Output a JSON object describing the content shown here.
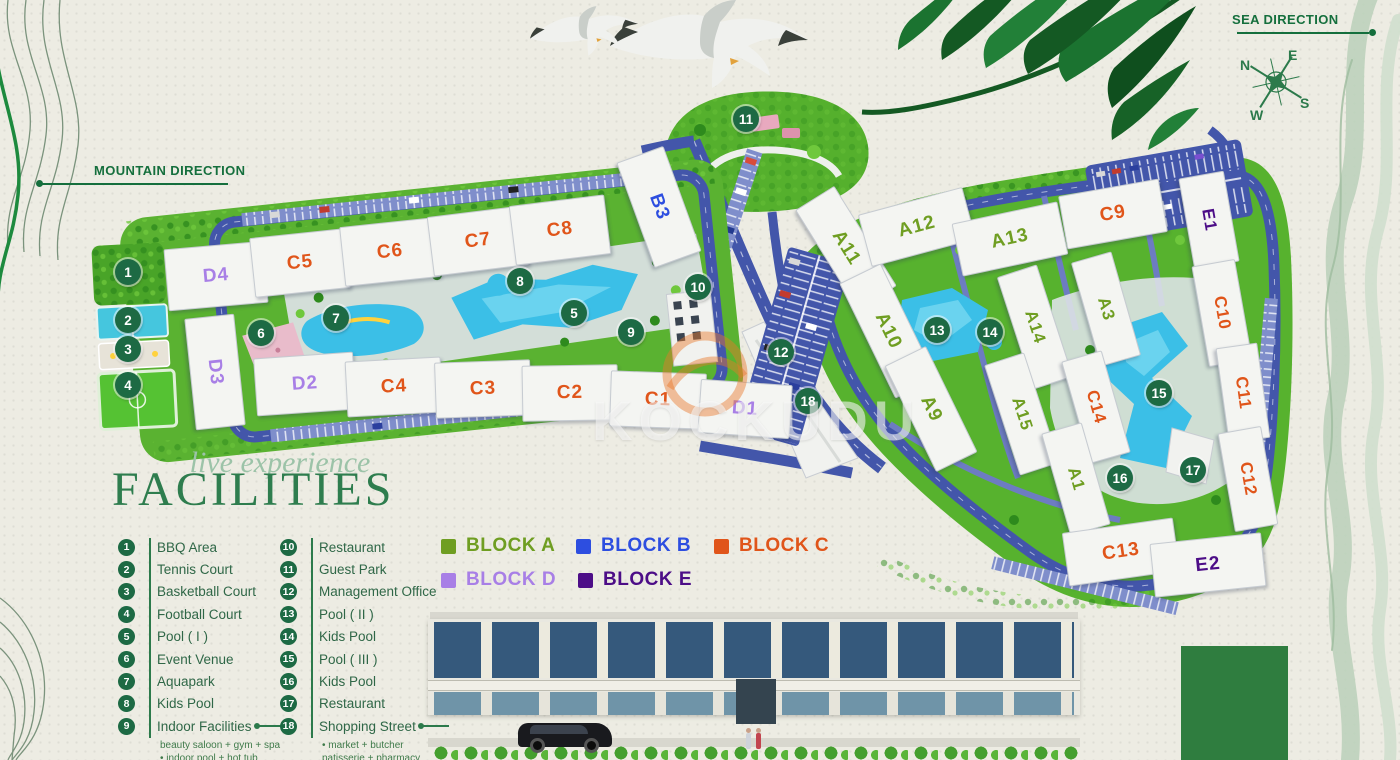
{
  "directions": {
    "sea": "SEA DIRECTION",
    "mountain": "MOUNTAIN DIRECTION"
  },
  "compass": {
    "n": "N",
    "e": "E",
    "s": "S",
    "w": "W"
  },
  "title": {
    "script": "live experience",
    "main": "FACILITIES"
  },
  "facilities": [
    {
      "num": "1",
      "label": "BBQ Area"
    },
    {
      "num": "2",
      "label": "Tennis Court"
    },
    {
      "num": "3",
      "label": "Basketball Court"
    },
    {
      "num": "4",
      "label": "Football Court"
    },
    {
      "num": "5",
      "label": "Pool ( I )"
    },
    {
      "num": "6",
      "label": "Event Venue"
    },
    {
      "num": "7",
      "label": "Aquapark"
    },
    {
      "num": "8",
      "label": "Kids Pool"
    },
    {
      "num": "9",
      "label": "Indoor Facilities",
      "notes": [
        "beauty saloon + gym + spa",
        "indoor pool + hot tub"
      ]
    },
    {
      "num": "10",
      "label": "Restaurant"
    },
    {
      "num": "11",
      "label": "Guest Park"
    },
    {
      "num": "12",
      "label": "Management Office"
    },
    {
      "num": "13",
      "label": "Pool ( II )"
    },
    {
      "num": "14",
      "label": "Kids Pool"
    },
    {
      "num": "15",
      "label": "Pool ( III )"
    },
    {
      "num": "16",
      "label": "Kids Pool"
    },
    {
      "num": "17",
      "label": "Restaurant"
    },
    {
      "num": "18",
      "label": "Shopping Street",
      "notes": [
        "market + butcher",
        "patisserie + pharmacy"
      ]
    }
  ],
  "blocks": [
    {
      "key": "a",
      "label": "BLOCK A",
      "color": "#6f9e22"
    },
    {
      "key": "b",
      "label": "BLOCK B",
      "color": "#2d4ee0"
    },
    {
      "key": "c",
      "label": "BLOCK C",
      "color": "#e0551a"
    },
    {
      "key": "d",
      "label": "BLOCK D",
      "color": "#a87fe6"
    },
    {
      "key": "e",
      "label": "BLOCK E",
      "color": "#4c0d87"
    }
  ],
  "map": {
    "buildings": [
      {
        "label": "D4",
        "block": "D"
      },
      {
        "label": "C5",
        "block": "C"
      },
      {
        "label": "C6",
        "block": "C"
      },
      {
        "label": "C7",
        "block": "C"
      },
      {
        "label": "C8",
        "block": "C"
      },
      {
        "label": "B3",
        "block": "B"
      },
      {
        "label": "D3",
        "block": "D"
      },
      {
        "label": "D2",
        "block": "D"
      },
      {
        "label": "C4",
        "block": "C"
      },
      {
        "label": "C3",
        "block": "C"
      },
      {
        "label": "C2",
        "block": "C"
      },
      {
        "label": "C1",
        "block": "C"
      },
      {
        "label": "D1",
        "block": "D"
      },
      {
        "label": "A11",
        "block": "A"
      },
      {
        "label": "A12",
        "block": "A"
      },
      {
        "label": "A13",
        "block": "A"
      },
      {
        "label": "C9",
        "block": "C"
      },
      {
        "label": "E1",
        "block": "E"
      },
      {
        "label": "A10",
        "block": "A"
      },
      {
        "label": "A9",
        "block": "A"
      },
      {
        "label": "A14",
        "block": "A"
      },
      {
        "label": "A15",
        "block": "A"
      },
      {
        "label": "A3",
        "block": "A"
      },
      {
        "label": "C10",
        "block": "C"
      },
      {
        "label": "C14",
        "block": "C"
      },
      {
        "label": "A1",
        "block": "A"
      },
      {
        "label": "C11",
        "block": "C"
      },
      {
        "label": "C12",
        "block": "C"
      },
      {
        "label": "C13",
        "block": "C"
      },
      {
        "label": "E2",
        "block": "E"
      }
    ]
  },
  "watermark": "KOCKUDU",
  "colors": {
    "road": "#4356aa",
    "land": "#57b22e",
    "pool": "#3bbfe7",
    "paper": "#edece3",
    "heading": "#2e7d4e",
    "marker": "#1d6a44"
  }
}
